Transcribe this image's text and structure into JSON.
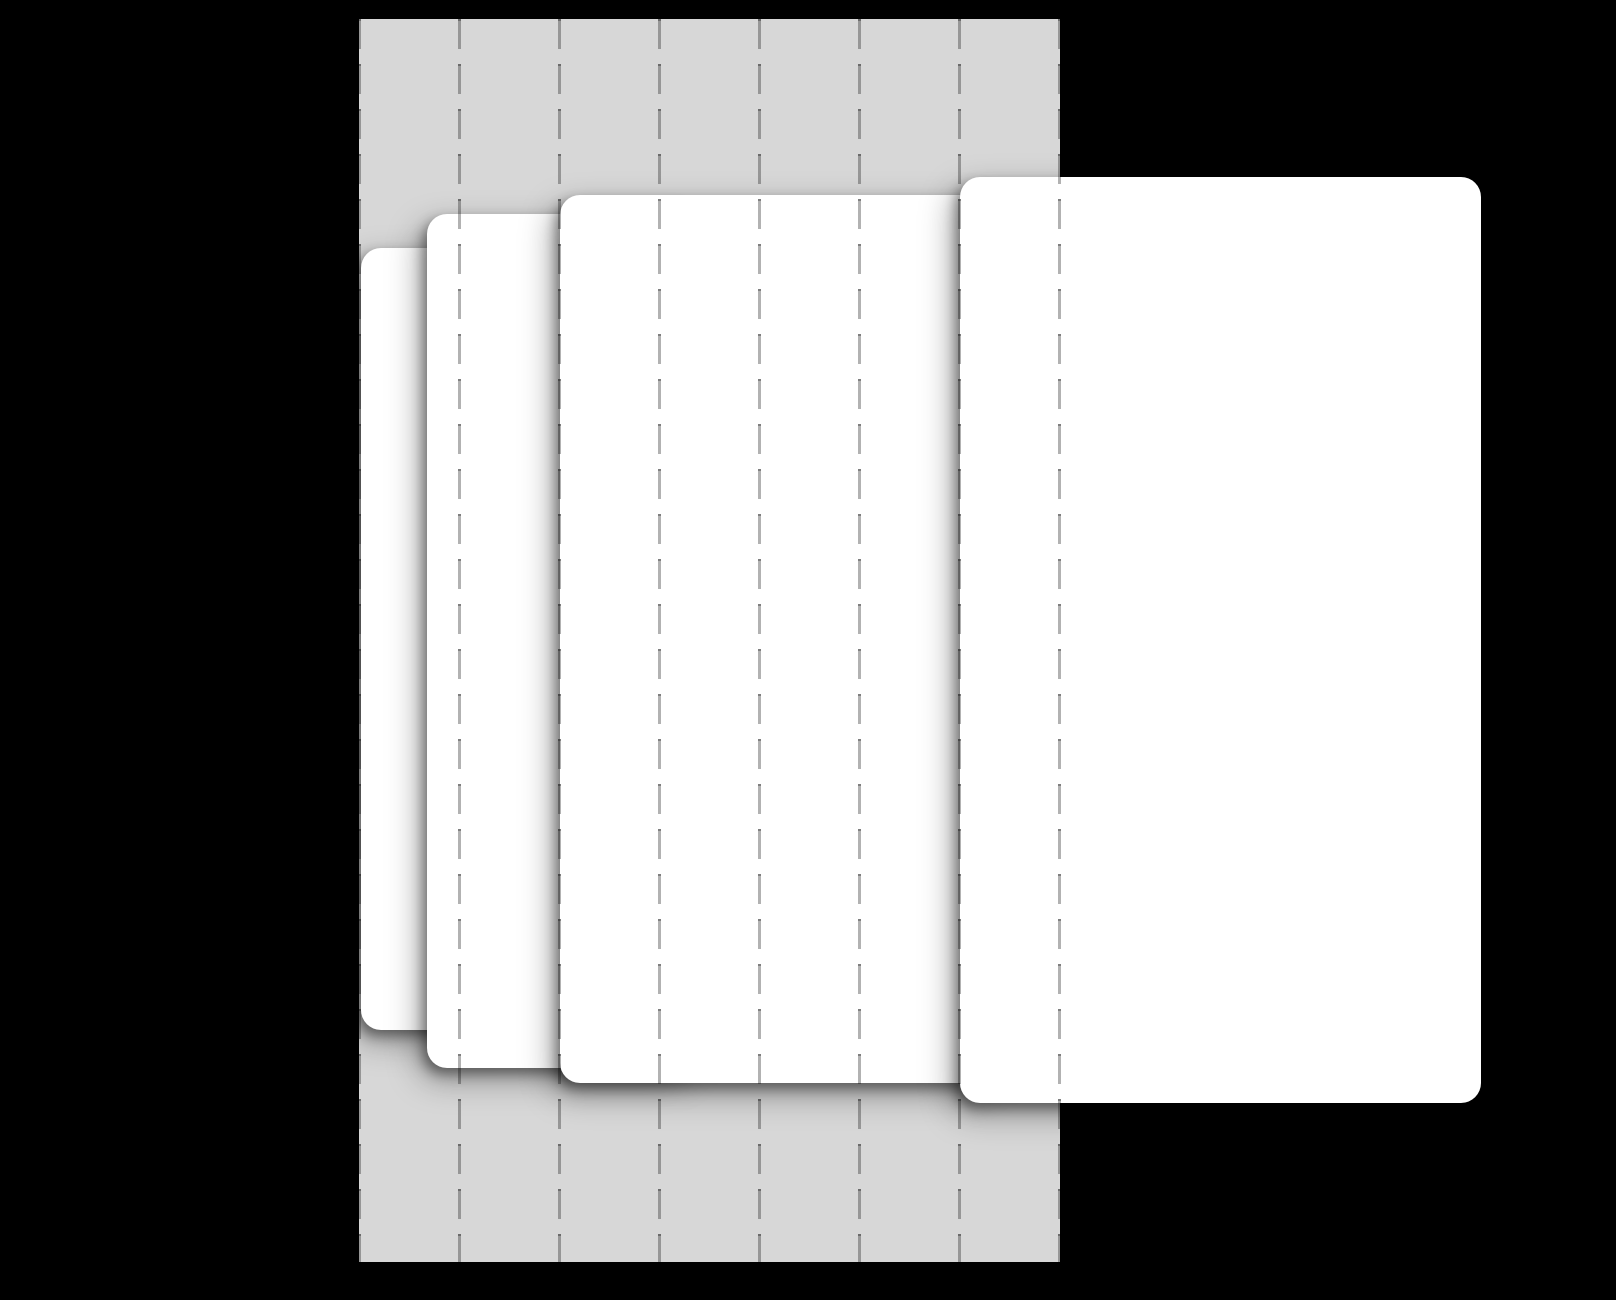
{
  "figure": {
    "type": "layered-blank-cards-over-dashed-grid-band",
    "canvas": {
      "width": 1616,
      "height": 1300
    },
    "colors": {
      "background": "#000000",
      "band": "#d7d7d7",
      "card": "#ffffff",
      "gridline": "rgba(0,0,0,0.30)",
      "gridline_cap": "rgba(0,0,0,0.50)",
      "shadow_tight": "rgba(0,0,0,0.40)",
      "shadow_soft": "rgba(0,0,0,0.35)"
    },
    "band": {
      "x": 359,
      "y": 19,
      "width": 701,
      "height": 1243
    },
    "gridlines": {
      "count": 8,
      "spacing": 100,
      "line_width": 3,
      "dash_length": 30,
      "gap_length": 15,
      "cap_length": 2
    },
    "cards": [
      {
        "x": 361,
        "y": 248,
        "width": 160,
        "height": 782
      },
      {
        "x": 427,
        "y": 214,
        "width": 270,
        "height": 854
      },
      {
        "x": 560,
        "y": 195,
        "width": 440,
        "height": 888
      },
      {
        "x": 960,
        "y": 177,
        "width": 521,
        "height": 926
      }
    ],
    "card_corner_radius": 20
  }
}
